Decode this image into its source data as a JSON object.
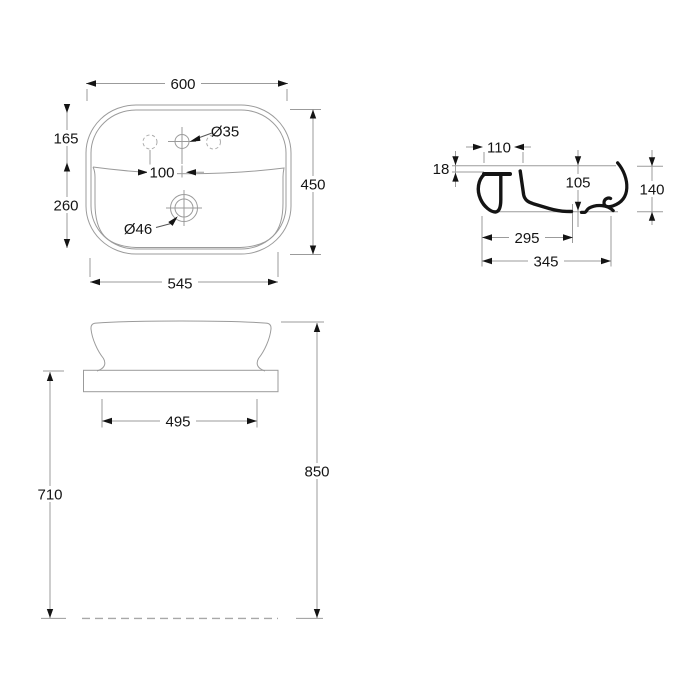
{
  "drawing": {
    "type": "washbasin-technical-drawing",
    "colors": {
      "ink": "#141414",
      "thin_line": "#9b9b9b",
      "background": "#ffffff"
    },
    "plan_view": {
      "dims": {
        "overall_width": "600",
        "overall_depth": "450",
        "rear_depth": "165",
        "front_depth": "260",
        "bottom_width": "545",
        "tap_hole_spacing": "100",
        "tap_hole_diameter": "Ø35",
        "drain_hole_diameter": "Ø46"
      }
    },
    "section_view": {
      "dims": {
        "rear_ledge_width": "110",
        "rim_thickness": "18",
        "bowl_depth": "105",
        "basin_height": "140",
        "drain_distance": "295",
        "overall_depth": "345"
      }
    },
    "front_view": {
      "dims": {
        "base_width": "495",
        "counter_height": "710",
        "overall_height": "850"
      }
    }
  }
}
